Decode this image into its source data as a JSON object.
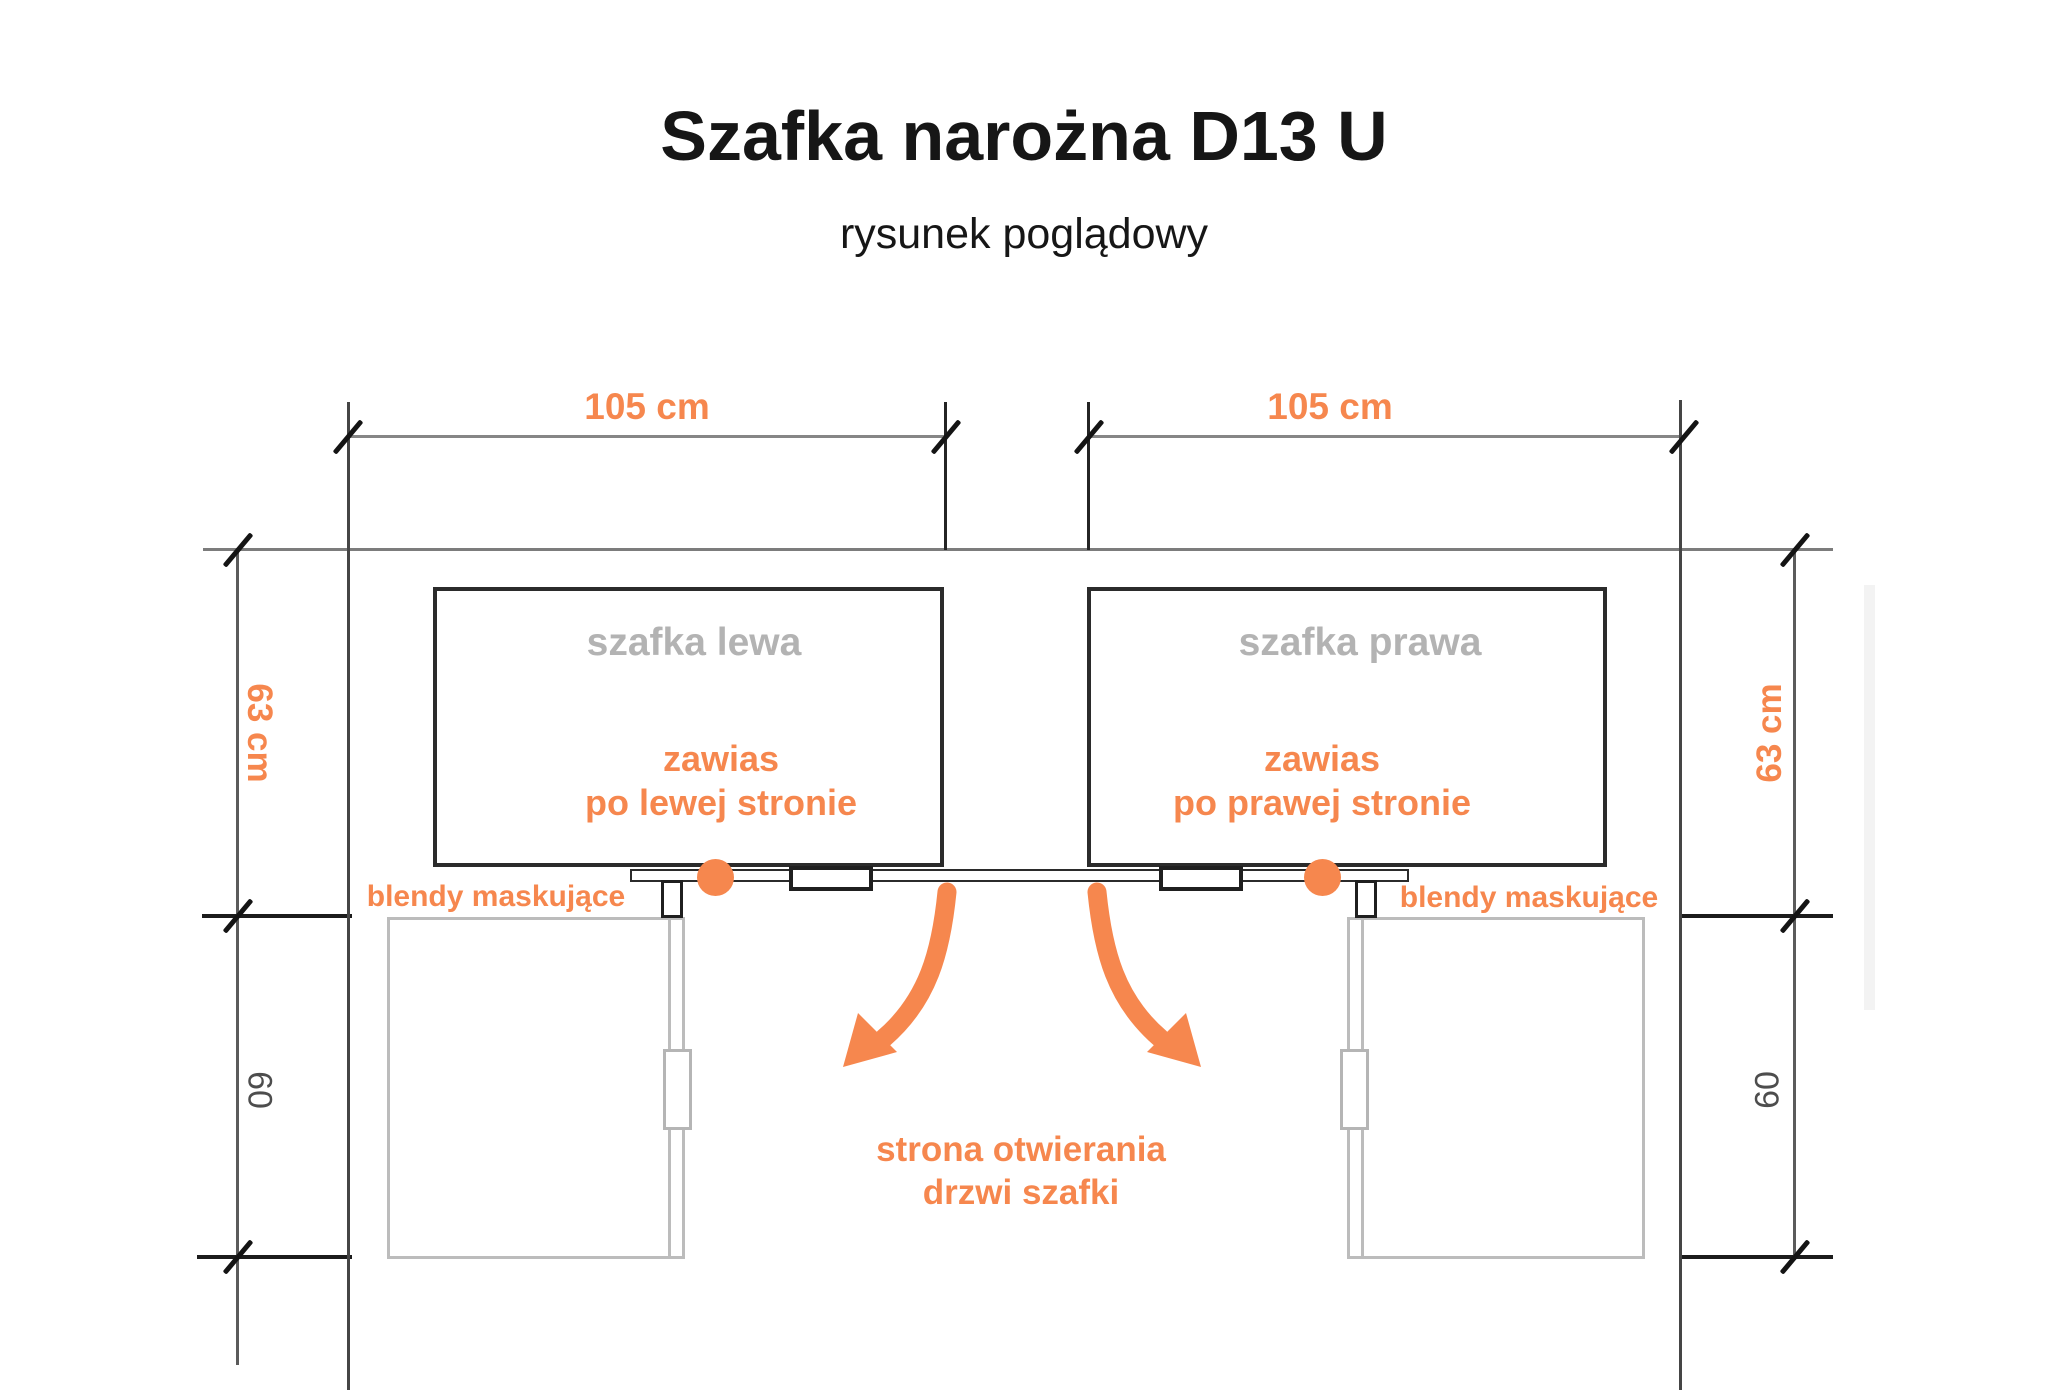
{
  "title": "Szafka narożna D13 U",
  "subtitle": "rysunek poglądowy",
  "colors": {
    "accent_orange": "#F6874E",
    "cabinet_name_gray": "#B3B3B3",
    "dim_number_gray": "#4D4D4D",
    "outline_black": "#1F1F1F",
    "dimension_line_gray": "#7C7C7C",
    "door_outline_gray": "#BCBCBC",
    "background": "#FFFFFF"
  },
  "dimensions": {
    "top_left": "105 cm",
    "top_right": "105 cm",
    "left_depth": "63 cm",
    "left_lower": "60",
    "right_depth": "63 cm",
    "right_lower": "60"
  },
  "cabinets": {
    "left": {
      "name": "szafka lewa",
      "hinge_line1": "zawias",
      "hinge_line2": "po lewej stronie",
      "blende_label": "blendy maskujące"
    },
    "right": {
      "name": "szafka prawa",
      "hinge_line1": "zawias",
      "hinge_line2": "po prawej stronie",
      "blende_label": "blendy maskujące"
    }
  },
  "opening_note": {
    "line1": "strona otwierania",
    "line2": "drzwi szafki"
  },
  "icons": {
    "hinge_left": "hinge-dot",
    "hinge_right": "hinge-dot",
    "arrow_left": "curved-arrow-down-left",
    "arrow_right": "curved-arrow-down-right"
  }
}
